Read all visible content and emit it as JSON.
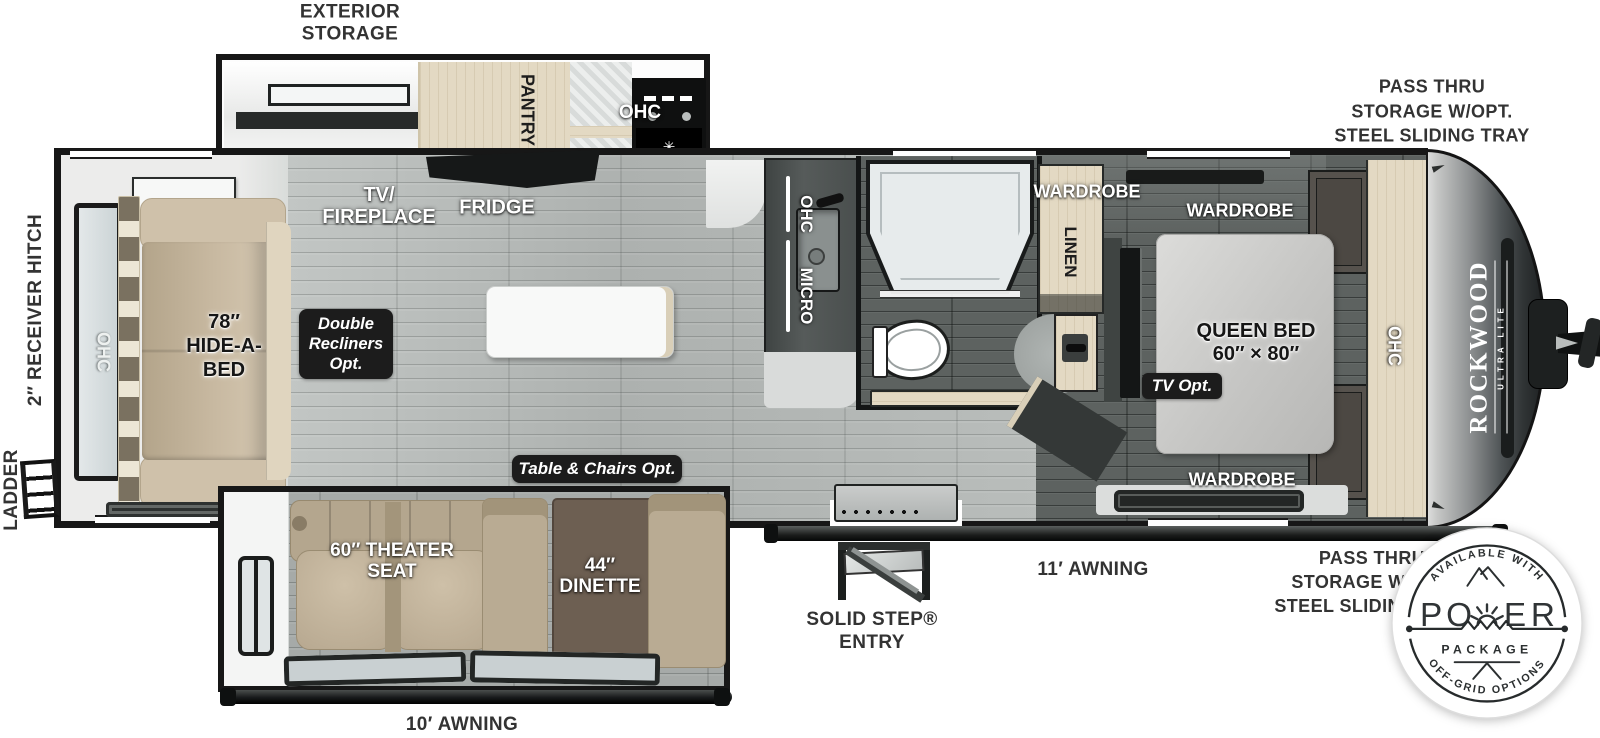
{
  "title": "Rockwood Ultra Lite travel trailer floorplan",
  "brand": {
    "name": "ROCKWOOD",
    "sub": "ULTRA LITE"
  },
  "exterior_labels": {
    "exterior_storage": [
      "EXTERIOR",
      "STORAGE"
    ],
    "pass_thru_front_top": [
      "PASS THRU",
      "STORAGE W/OPT.",
      "STEEL SLIDING TRAY"
    ],
    "pass_thru_front_bottom": [
      "PASS THRU",
      "STORAGE W/OPT.",
      "STEEL SLIDING TRAY"
    ],
    "receiver_hitch": "2″ RECEIVER HITCH",
    "ladder": "LADDER",
    "solid_step_entry": [
      "SOLID STEP®",
      "ENTRY"
    ],
    "awning_door_side": "11′ AWNING",
    "awning_camp_side": "10′ AWNING"
  },
  "interior_labels": {
    "tv_fireplace": [
      "TV/",
      "FIREPLACE"
    ],
    "fridge": "FRIDGE",
    "pantry": "PANTRY",
    "ohc_kitchen": "OHC",
    "ohc_counter": "OHC",
    "micro_counter": "MICRO",
    "ohc_rear": "OHC",
    "ohc_bedroom": "OHC",
    "wardrobe_hall": "WARDROBE",
    "linen": "LINEN",
    "wardrobe_bed_top": "WARDROBE",
    "wardrobe_bed_bottom": "WARDROBE",
    "queen_bed": [
      "QUEEN BED",
      "60″ × 80″"
    ],
    "hide_a_bed": [
      "78″",
      "HIDE-A-",
      "BED"
    ],
    "theater_seat": [
      "60″ THEATER",
      "SEAT"
    ],
    "dinette": [
      "44″",
      "DINETTE"
    ]
  },
  "option_badges": {
    "double_recliners": [
      "Double",
      "Recliners",
      "Opt."
    ],
    "table_chairs": "Table & Chairs Opt.",
    "tv_opt": "TV Opt."
  },
  "power_package_badge": {
    "arc_top": "AVAILABLE WITH",
    "word_letters": [
      "P",
      "O",
      "E",
      "R"
    ],
    "word_line2": "PACKAGE",
    "arc_bottom": "OFF-GRID OPTIONS"
  },
  "colors": {
    "wall": "#171717",
    "floor_main": "#b6bab8",
    "floor_dark": "#5d6260",
    "wood": "#e3d9c3",
    "sofa": "#c4b59d",
    "badge_bg": "#1c1c1c",
    "tv_screen": "#8e8fd8",
    "front_cap_dark": "#2b2e2f"
  }
}
